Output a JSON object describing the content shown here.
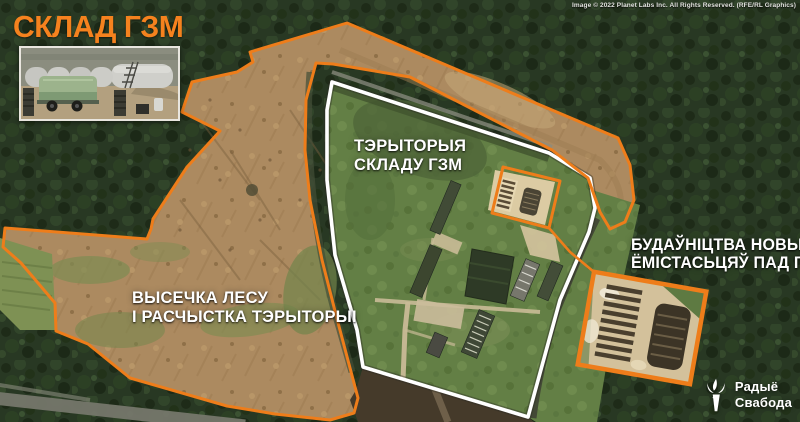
{
  "title": "СКЛАД ГЗМ",
  "credit": "Image © 2022 Planet Labs Inc. All Rights Reserved. (RFE/RL Graphics)",
  "annotations": {
    "territory_label": {
      "line1": "ТЭРЫТОРЫЯ",
      "line2": "СКЛАДУ ГЗМ"
    },
    "clearing_label": {
      "line1": "ВЫСЕЧКА ЛЕСУ",
      "line2": "І РАСЧЫСТКА ТЭРЫТОРЫІ"
    },
    "construction_label": {
      "line1": "БУДАЎНІЦТВА НОВЫХ",
      "line2": "ЁМІСТАСЬЦЯЎ ПАД ГЗМ"
    }
  },
  "logo": {
    "name_line1": "Радыё",
    "name_line2": "Свабода",
    "icon": "torch-icon"
  },
  "colors": {
    "accent_orange": "#EE7D1A",
    "fence_white": "#FFFFFF",
    "forest_green": "#283823",
    "cleared_tan": "#AC8A60"
  }
}
